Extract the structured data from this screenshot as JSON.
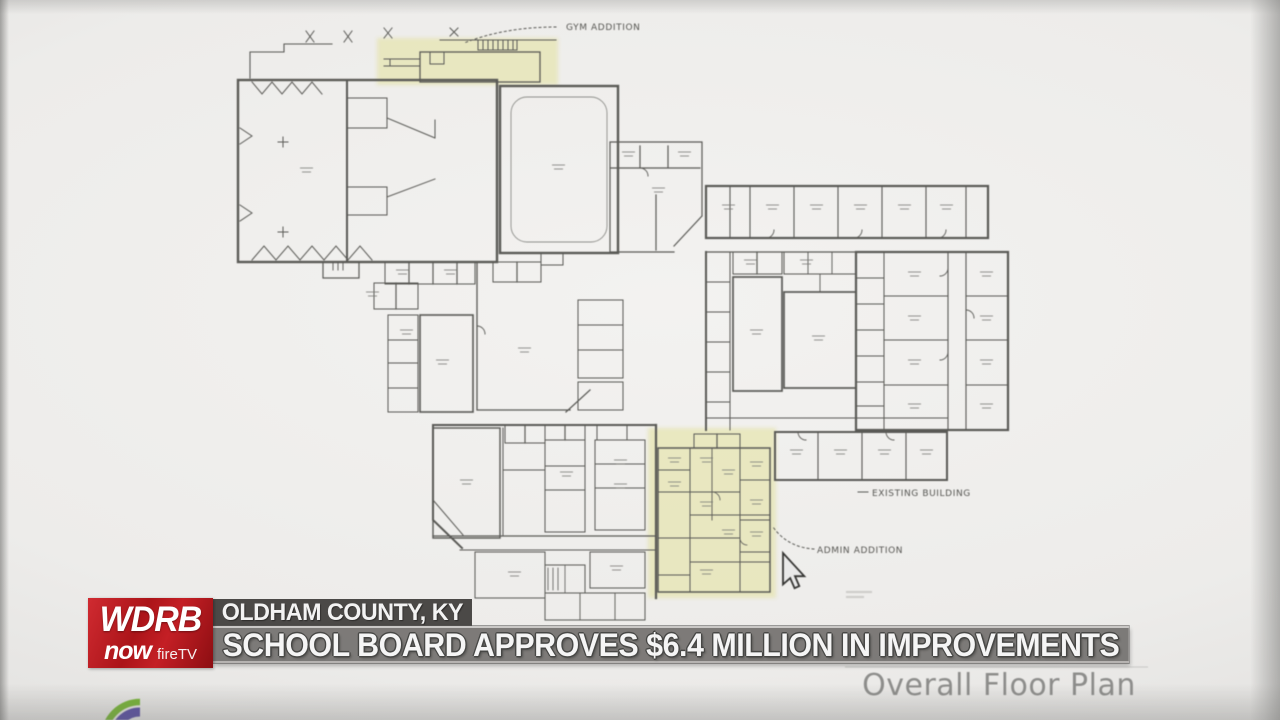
{
  "broadcast": {
    "station_logo": {
      "station": "WDRB",
      "platform": "now",
      "device": "fireTV"
    },
    "location_tag": "OLDHAM COUNTY, KY",
    "headline": "SCHOOL BOARD APPROVES $6.4 MILLION IN IMPROVEMENTS",
    "colors": {
      "logo_red": "#b5181d",
      "location_bg": "#3e3c3a",
      "headline_bg": "#706e6c",
      "headline_text": "#f5f5f5"
    }
  },
  "floor_plan": {
    "labels": {
      "gym_addition": "GYM ADDITION",
      "existing_building": "EXISTING BUILDING",
      "admin_addition": "ADMIN ADDITION"
    },
    "title": "Overall Floor Plan",
    "highlight_color": "#e6e5b3",
    "ink_color": "#53534f"
  }
}
